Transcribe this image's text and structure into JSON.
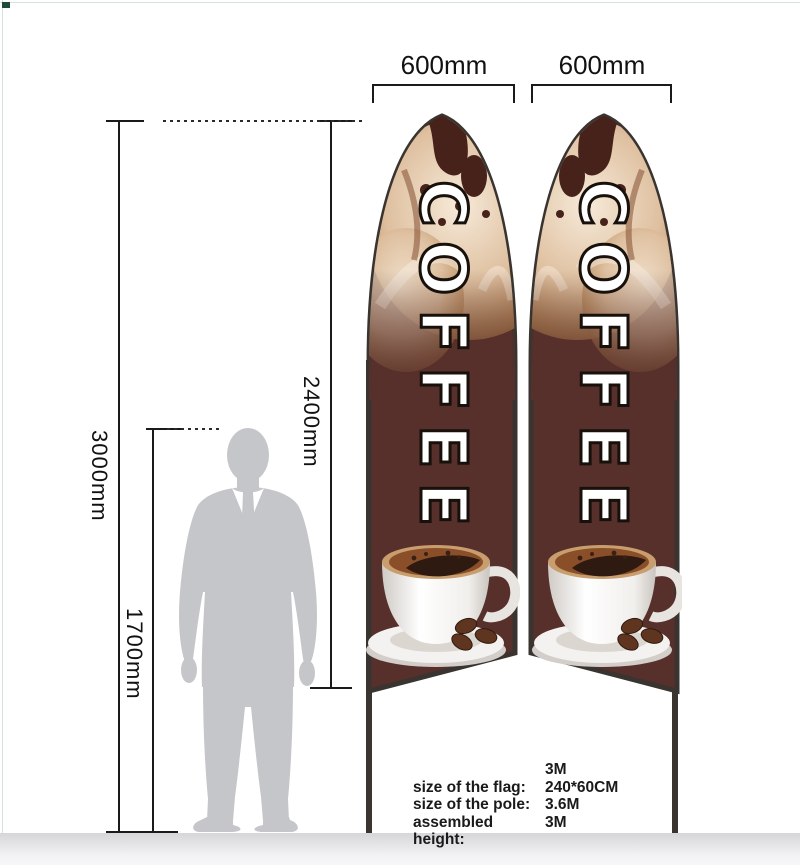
{
  "dimensions": {
    "total_height": "3000mm",
    "flag_length": "2400mm",
    "person_height": "1700mm",
    "flag_width_left": "600mm",
    "flag_width_right": "600mm"
  },
  "flags": {
    "text": "COFFEE",
    "body_color": "#57302b",
    "outline_color": "#3a3430"
  },
  "specs": {
    "rows": [
      {
        "label": "",
        "value": "3M"
      },
      {
        "label": "size of the flag:",
        "value": "240*60CM"
      },
      {
        "label": "size of the pole:",
        "value": "3.6M"
      },
      {
        "label": "assembled height:",
        "value": "3M"
      }
    ]
  }
}
